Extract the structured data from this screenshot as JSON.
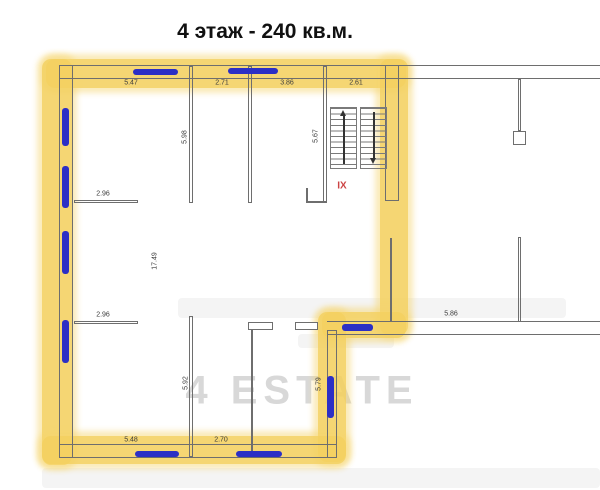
{
  "title": "4 этаж - 240 кв.м.",
  "watermark": "4 ESTATE",
  "stairwell": {
    "label": "IX",
    "flights": 2,
    "icons": [
      "stairs-up-arrow",
      "stairs-down-arrow"
    ]
  },
  "dimensions": {
    "top": [
      "5.47",
      "2.71",
      "3.86",
      "2.61"
    ],
    "v_598": "5.98",
    "v_567": "5.67",
    "h_296_upper": "2.96",
    "v_1749": "17.49",
    "h_296_lower": "2.96",
    "v_592": "5.92",
    "v_579": "5.79",
    "h_548": "5.48",
    "h_270": "2.70",
    "h_586": "5.86"
  },
  "colors": {
    "highlight": "#f4d160",
    "window_marker": "#2c2fc5",
    "wall": "#6e6e6e",
    "stair_label": "#cc4444",
    "watermark": "#d8d8d8"
  }
}
